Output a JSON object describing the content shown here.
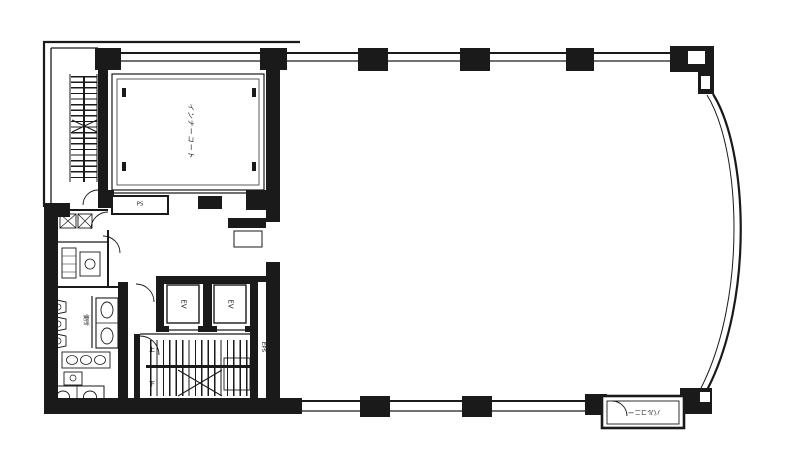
{
  "colors": {
    "ink": "#1a1a1a",
    "paper": "#ffffff"
  },
  "plan": {
    "inner_court_label": "インナーコート",
    "ps_label": "PS",
    "elevator_label": "EV",
    "eps_label": "EPS",
    "toilet_label": "便所",
    "stair_up_label": "上",
    "stair_down_label": "下",
    "balcony_label": "バルコニー"
  }
}
